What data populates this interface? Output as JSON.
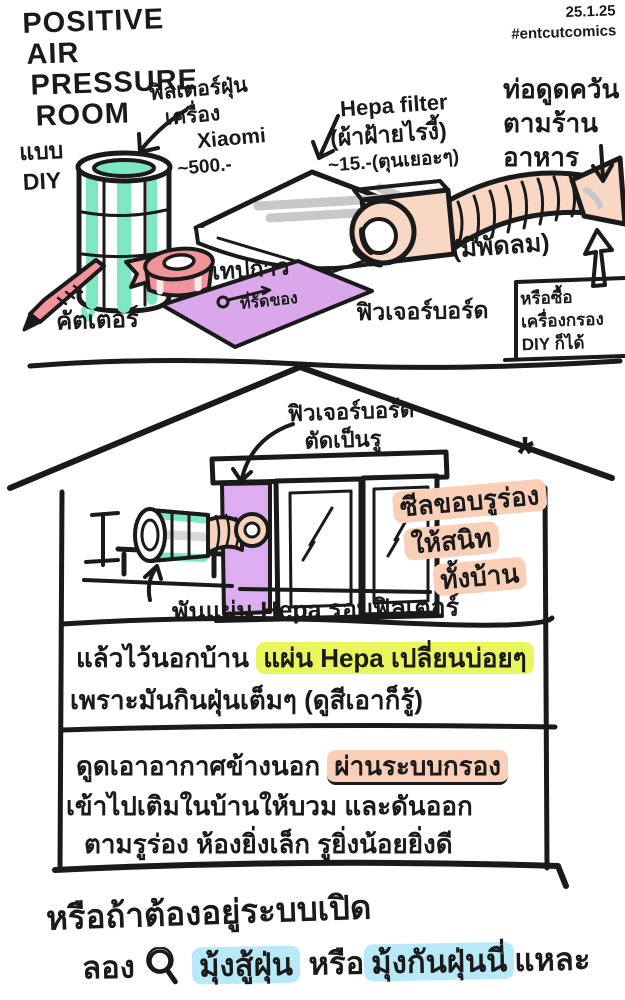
{
  "header": {
    "title_lines": [
      "POSITIVE",
      "AIR",
      "PRESSURE",
      "ROOM"
    ],
    "date": "25.1.25",
    "hashtag": "#entcutcomics",
    "diy_line1": "แบบ",
    "diy_line2": "DIY"
  },
  "materials": {
    "filter_label_line1": "ฟิลเตอร์ฝุ่น",
    "filter_label_line2": "เครื่อง",
    "filter_label_line3": "Xiaomi",
    "filter_price": "~500.-",
    "hepa_label_line1": "Hepa filter",
    "hepa_label_line2": "(ผ้าฝ้ายไรงี้)",
    "hepa_price": "~15.-(ตุนเยอะๆ)",
    "duct_label_line1": "ท่อดูดควัน",
    "duct_label_line2": "ตามร้าน",
    "duct_label_line3": "อาหาร",
    "fan_note": "(มีพัดลม)",
    "cutter_label": "คัตเตอร์",
    "tape_label": "เทปกาว",
    "tie_label": "ที่รัดของ",
    "board_label": "ฟิวเจอร์บอร์ด",
    "buy_box_line1": "หรือซื้อ",
    "buy_box_line2": "เครื่องกรอง",
    "buy_box_line3": "DIY ก็ได้"
  },
  "house": {
    "board_cut_line1": "ฟิวเจอร์บอร์ด",
    "board_cut_line2": "ตัดเป็นรู",
    "asterisk": "*",
    "seal_line1": "ซีลขอบรูร่อง",
    "seal_line2": "ให้สนิท",
    "seal_line3": "ทั้งบ้าน",
    "wrap_label": "พันแผ่น Hepa รอบฟิลเตอร์"
  },
  "notes": {
    "note1_prefix": "แล้วไว้นอกบ้าน ",
    "note1_highlight": "แผ่น Hepa เปลี่ยนบ่อยๆ",
    "note1_line2": "เพราะมันกินฝุ่นเต็มๆ (ดูสีเอาก็รู้)",
    "note2_prefix": "ดูดเอาอากาศข้างนอก ",
    "note2_highlight": "ผ่านระบบกรอง",
    "note2_line2": "เข้าไปเติมในบ้านให้บวม และดันออก",
    "note2_line3": "ตามรูร่อง ห้องยิ่งเล็ก รูยิ่งน้อยยิ่งดี"
  },
  "footer": {
    "line1": "หรือถ้าต้องอยู่ระบบเปิด",
    "try_word": "ลอง",
    "highlight1": "มุ้งสู้ฝุ่น",
    "mid_word": "หรือ",
    "highlight2": "มุ้งกันฝุ่นนี่",
    "suffix": "แหละ"
  },
  "colors": {
    "ink": "#1a1a1a",
    "mint": "#7de7c1",
    "pink": "#f1939b",
    "purple": "#d9a7ea",
    "peach": "#f8d7c4",
    "highlight_yellow": "#e9f65c",
    "highlight_blue": "#b8e9f8",
    "highlight_peach": "#f9cfb8"
  }
}
